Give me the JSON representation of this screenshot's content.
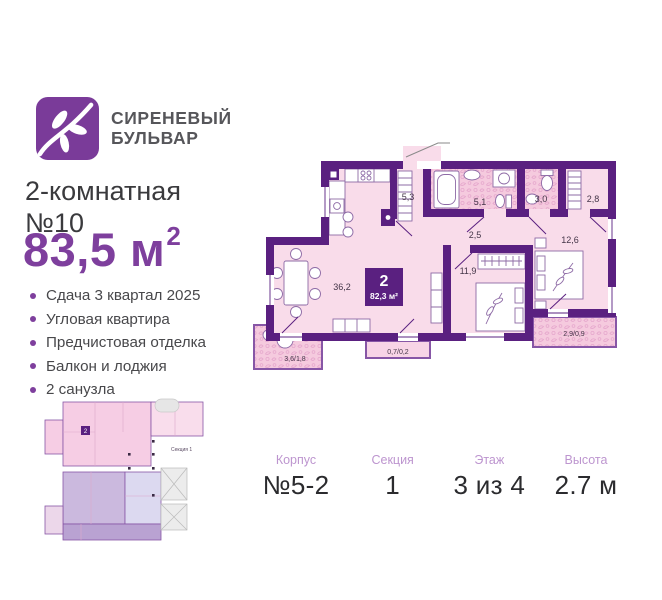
{
  "logo": {
    "line1": "СИРЕНЕВЫЙ",
    "line2": "БУЛЬВАР"
  },
  "title": {
    "line1": "2-комнатная",
    "line2": "№10"
  },
  "area": {
    "value": "83,5",
    "unit": "м",
    "sup": "2"
  },
  "features": [
    "Сдача 3 квартал 2025",
    "Угловая квартира",
    "Предчистовая отделка",
    "Балкон и лоджия",
    "2 санузла"
  ],
  "floorplan": {
    "badge": {
      "rooms": "2",
      "area": "82,3 м²"
    },
    "rooms": [
      {
        "name": "living-room",
        "label": "36,2"
      },
      {
        "name": "hallway",
        "label": "5,3"
      },
      {
        "name": "bathroom-1",
        "label": "5,1"
      },
      {
        "name": "bathroom-2",
        "label": "3,0"
      },
      {
        "name": "wardrobe",
        "label": "2,8"
      },
      {
        "name": "corridor",
        "label": "2,5"
      },
      {
        "name": "bedroom-1",
        "label": "11,9"
      },
      {
        "name": "bedroom-2",
        "label": "12,6"
      },
      {
        "name": "loggia",
        "label": "3,6/1,8"
      },
      {
        "name": "balcony-small",
        "label": "0,7/0,2"
      },
      {
        "name": "balcony",
        "label": "2,9/0,9"
      }
    ]
  },
  "miniplan": {
    "section_label": "Секция 1",
    "badge": "2"
  },
  "info": [
    {
      "label": "Корпус",
      "value": "№5-2"
    },
    {
      "label": "Секция",
      "value": "1"
    },
    {
      "label": "Этаж",
      "value": "3 из 4"
    },
    {
      "label": "Высота",
      "value": "2.7 м"
    }
  ],
  "colors": {
    "accent": "#7e3f9d",
    "wall": "#5a2080",
    "room_fill": "#f9dcea",
    "pattern_fill": "#f5cade"
  }
}
